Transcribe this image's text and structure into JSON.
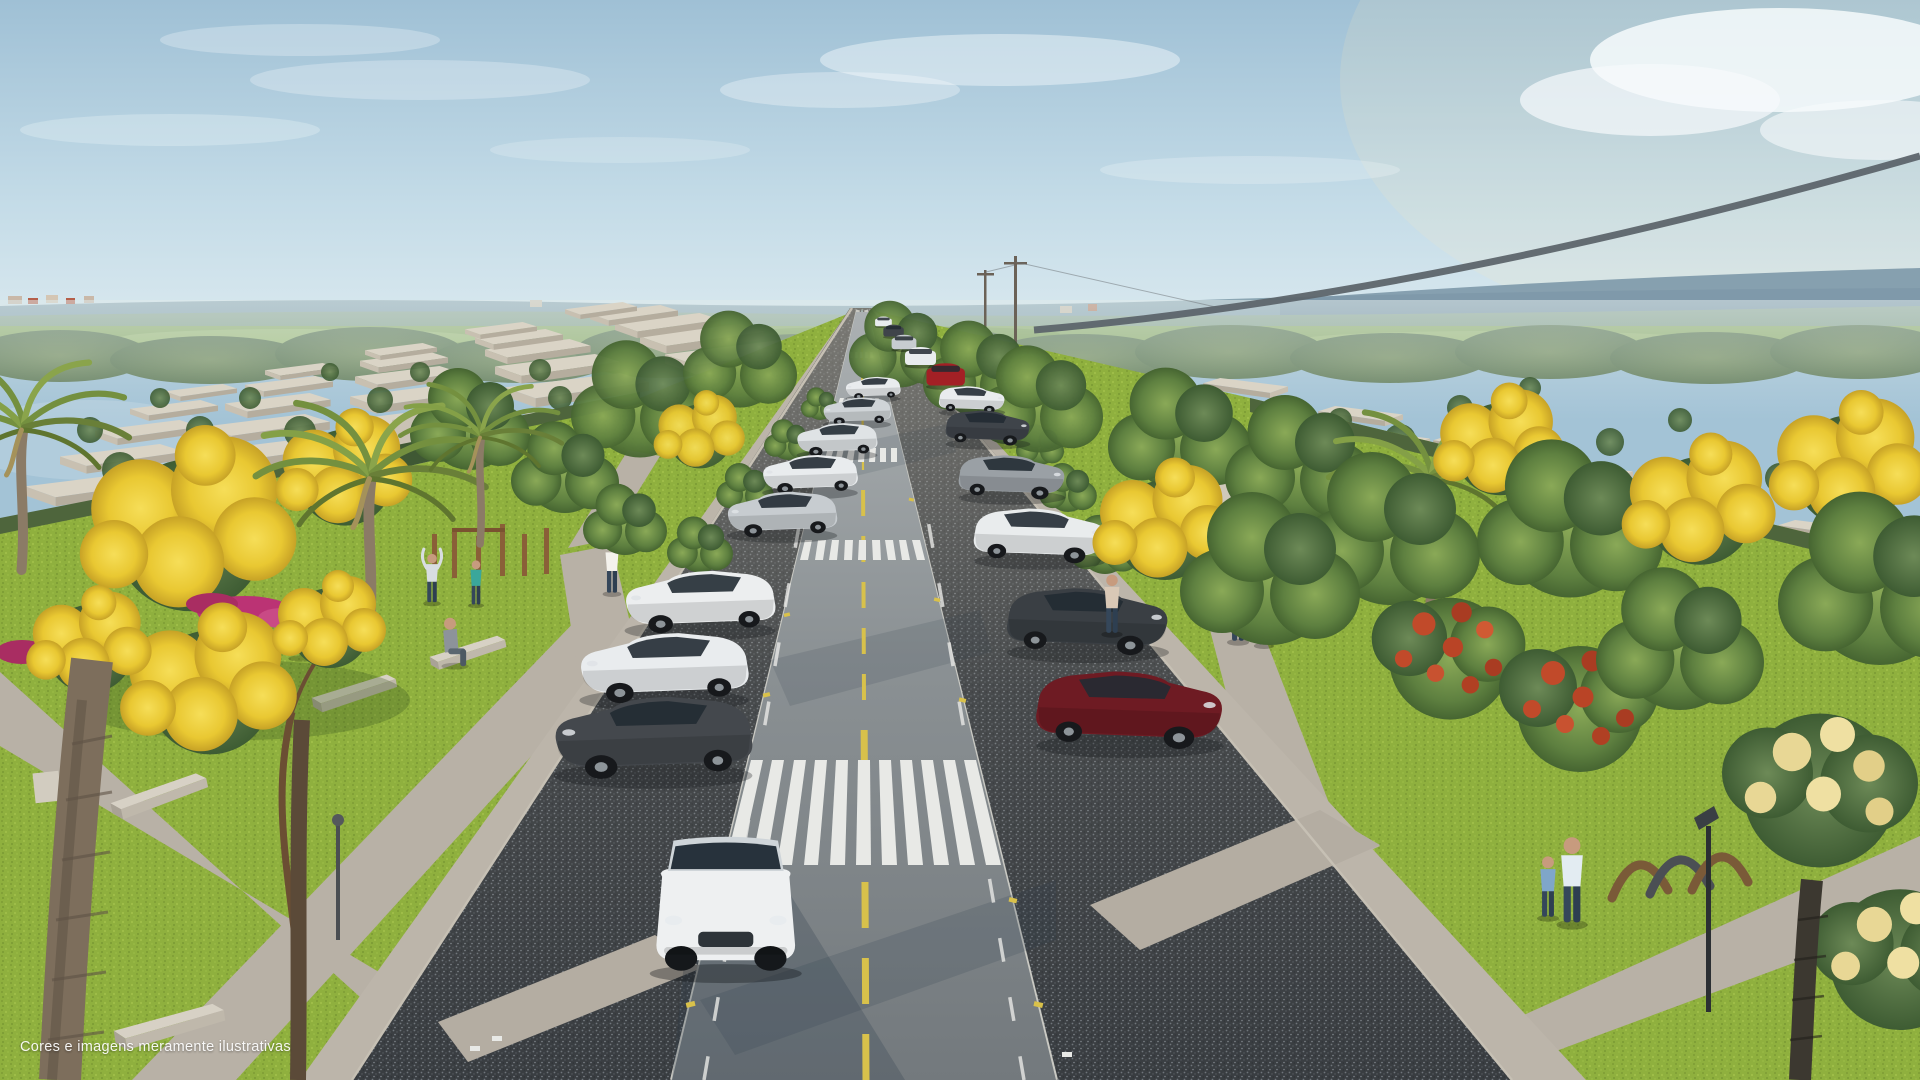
{
  "caption": {
    "text": "Cores e imagens meramente ilustrativas"
  },
  "scene": {
    "type": "architectural-render",
    "setting": "aerial 3D rendering of a residential condominium avenue with central road, zebra crosswalks, gravel parking strips, linear park with palms and flowering trees, and rows of flat-roof houses to the horizon",
    "palette": {
      "sky_top": "#a3c3d6",
      "sky_horizon": "#dcebf0",
      "cloud": "#f6fafc",
      "far_hills": "#8ba6b3",
      "far_fields": "#96b374",
      "far_trees": "#5f7f58",
      "house_roof": "#d9d3c5",
      "house_wall": "#b5ad9e",
      "road_near": "#767c80",
      "road_far": "#a9aeb0",
      "curb": "#c9c9c3",
      "gravel": "#393d41",
      "sidewalk": "#b8b1a6",
      "grass": "#8fb03e",
      "tree_green": "#5e8040",
      "flower_yellow": "#eacc35",
      "flower_pink": "#bb3374",
      "flower_red": "#bc4a2a",
      "flower_cream": "#e8d795",
      "lane_yellow": "#d8c14b",
      "crosswalk_white": "#e8e9e6",
      "car_white": "#e9ecee",
      "car_silver": "#c7ccd0",
      "car_dark_gray": "#44484d",
      "car_red": "#a32025",
      "car_maroon": "#6e1b23",
      "cable_gray": "#5d656b"
    },
    "objects": {
      "cars_parked_left": [
        "dark-gray hatchback",
        "white sedan",
        "white SUV",
        "silver hatchback",
        "white hatchback",
        "silver car",
        "white car",
        "white car far"
      ],
      "cars_parked_right": [
        "dark-red hatchback",
        "dark-gray SUV",
        "white SUV",
        "gray hatchback",
        "dark sedan",
        "white car far"
      ],
      "cars_on_road": [
        "white SUV approaching",
        "red hatchback",
        "white car",
        "silver car",
        "distant cars"
      ],
      "people": [
        "woman sitting on bench",
        "person sitting on bench",
        "person stretching",
        "person in teal",
        "man walking on park path",
        "two joggers",
        "woman standing by SUV",
        "father walking with child"
      ],
      "street_elements": [
        "zebra crosswalks",
        "dashed yellow center line",
        "gravel parking strips",
        "concrete sidewalks and park paths",
        "park benches",
        "outdoor gym posts",
        "playground arches",
        "street lamp",
        "overhead power cable",
        "flat-roof house rows"
      ]
    }
  }
}
